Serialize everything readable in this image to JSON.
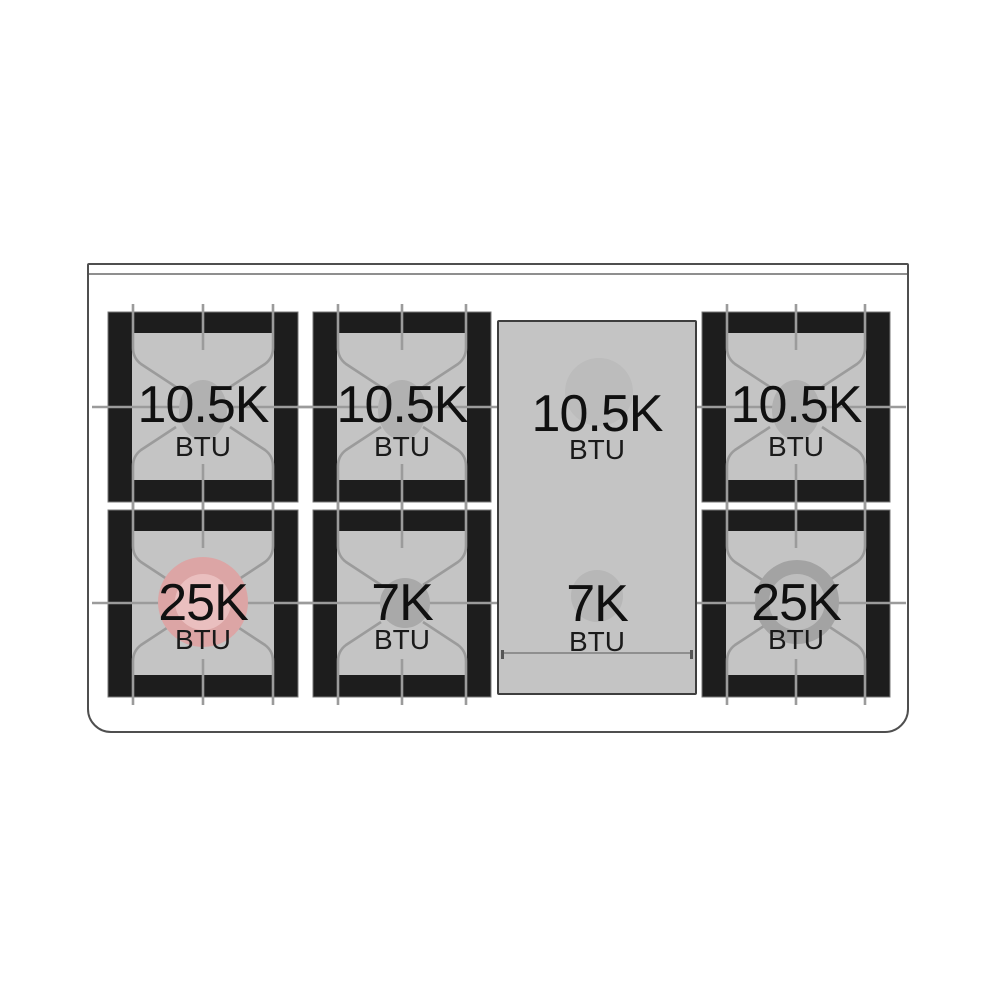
{
  "diagram": {
    "type": "range-cooktop-burner-layout",
    "unit": "BTU"
  },
  "cooktop": {
    "burners": [
      {
        "position": "top-left",
        "value": "10.5K",
        "label": "BTU"
      },
      {
        "position": "top-center",
        "value": "10.5K",
        "label": "BTU"
      },
      {
        "position": "top-right",
        "value": "10.5K",
        "label": "BTU"
      },
      {
        "position": "bottom-left",
        "value": "25K",
        "label": "BTU",
        "highlighted": true
      },
      {
        "position": "bottom-center",
        "value": "7K",
        "label": "BTU"
      },
      {
        "position": "bottom-right",
        "value": "25K",
        "label": "BTU"
      }
    ],
    "griddle_zones": [
      {
        "position": "griddle-top",
        "value": "10.5K",
        "label": "BTU"
      },
      {
        "position": "griddle-bottom",
        "value": "7K",
        "label": "BTU"
      }
    ]
  },
  "colors": {
    "outline_gray": "#4f4f4f",
    "grate_frame_black": "#1d1d1d",
    "surface_gray": "#c4c4c4",
    "grate_line_gray": "#9b9b9b",
    "burner_cap_gray": "#b1b1b1",
    "highlight_pink": "#dca5a5",
    "highlight_pink_inner": "#eabfbf"
  }
}
